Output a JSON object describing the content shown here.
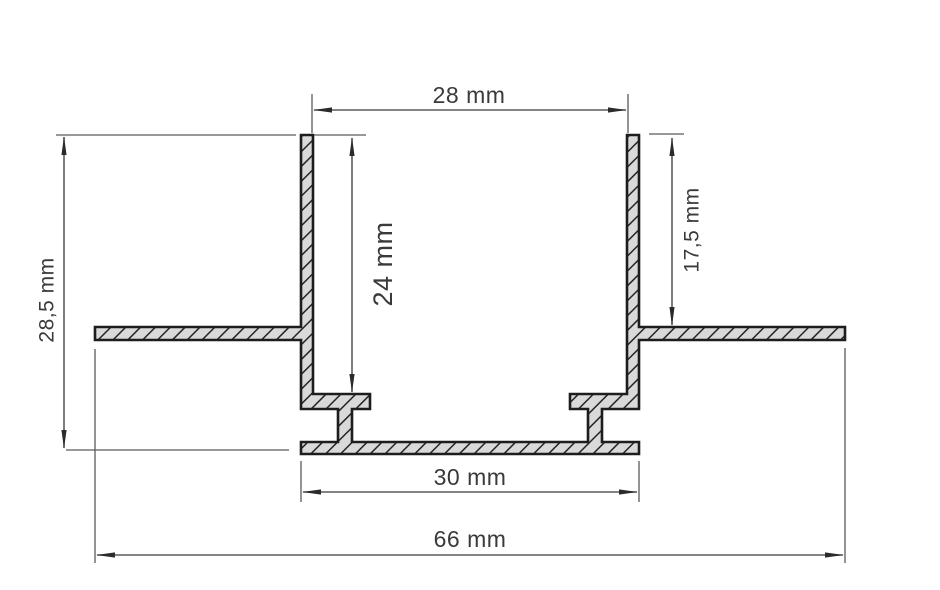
{
  "drawing": {
    "type": "aluminium-profile-cross-section",
    "unit": "mm",
    "dims": {
      "top_opening": {
        "label": "28 mm",
        "value": 28
      },
      "overall_height": {
        "label": "28,5 mm",
        "value": 28.5
      },
      "inner_depth": {
        "label": "24 mm",
        "value": 24
      },
      "flange_offset": {
        "label": "17,5 mm",
        "value": 17.5
      },
      "base_width": {
        "label": "30 mm",
        "value": 30
      },
      "overall_width": {
        "label": "66 mm",
        "value": 66
      }
    },
    "colors": {
      "background": "#ffffff",
      "profile_outline": "#1d1d1f",
      "profile_fill": "#d9d9d9",
      "hatch_line": "#242424",
      "dimension_line": "#5a5b5e",
      "arrow": "#2b2b2b",
      "label_text": "#3a3a3c"
    }
  }
}
